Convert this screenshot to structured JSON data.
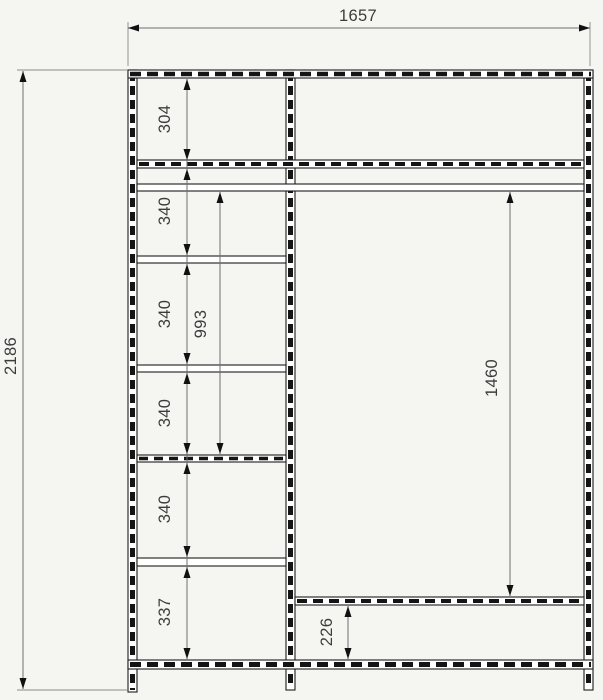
{
  "colors": {
    "background": "#f5f5f2",
    "structure_line": "#1d1d1d",
    "dimension_line": "#6f6f6f",
    "text": "#3c3c3c"
  },
  "drawing": {
    "dimensions": {
      "overall_width": "1657",
      "overall_height": "2186",
      "left_column_sections": [
        "304",
        "340",
        "340",
        "340",
        "340",
        "337"
      ],
      "left_column_span": "993",
      "right_section_height": "1460",
      "right_bottom_section": "226"
    }
  }
}
